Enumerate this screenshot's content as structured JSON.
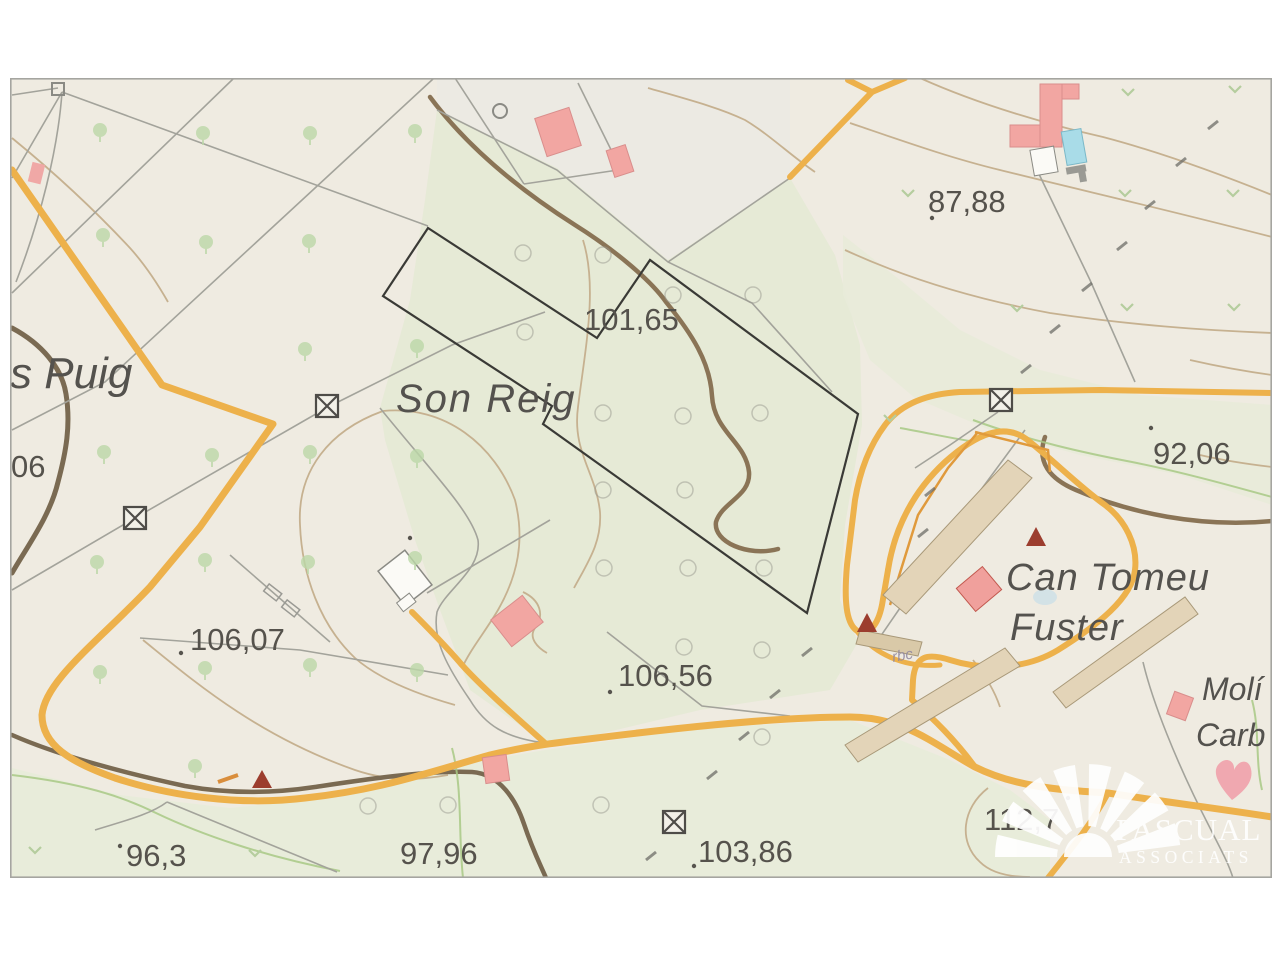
{
  "map": {
    "place_labels": {
      "s_puig": "s Puig",
      "son_reig": "Son Reig",
      "can_tomeu_line1": "Can Tomeu",
      "can_tomeu_line2": "Fuster",
      "moli": "Molí",
      "carb": "Carb",
      "track_note": "rbc"
    },
    "elevation_labels": {
      "left_partial": "06",
      "e101": "101,65",
      "e87": "87,88",
      "e92": "92,06",
      "e106a": "106,07",
      "e106b": "106,56",
      "e96": "96,3",
      "e97": "97,96",
      "e103": "103,86",
      "e112": "112,7"
    },
    "colors": {
      "background": "#EFEBE1",
      "field_green": "#E6EAD6",
      "road_yellow": "#EDB14B",
      "building_pink": "#F2A6A2",
      "contour_brown": "#8A7456",
      "boundary_black": "#3A3A36",
      "pool_blue": "#A9DCE8"
    }
  },
  "watermark": {
    "line1": "PASCUAL",
    "line2": "ASSOCIATS"
  }
}
